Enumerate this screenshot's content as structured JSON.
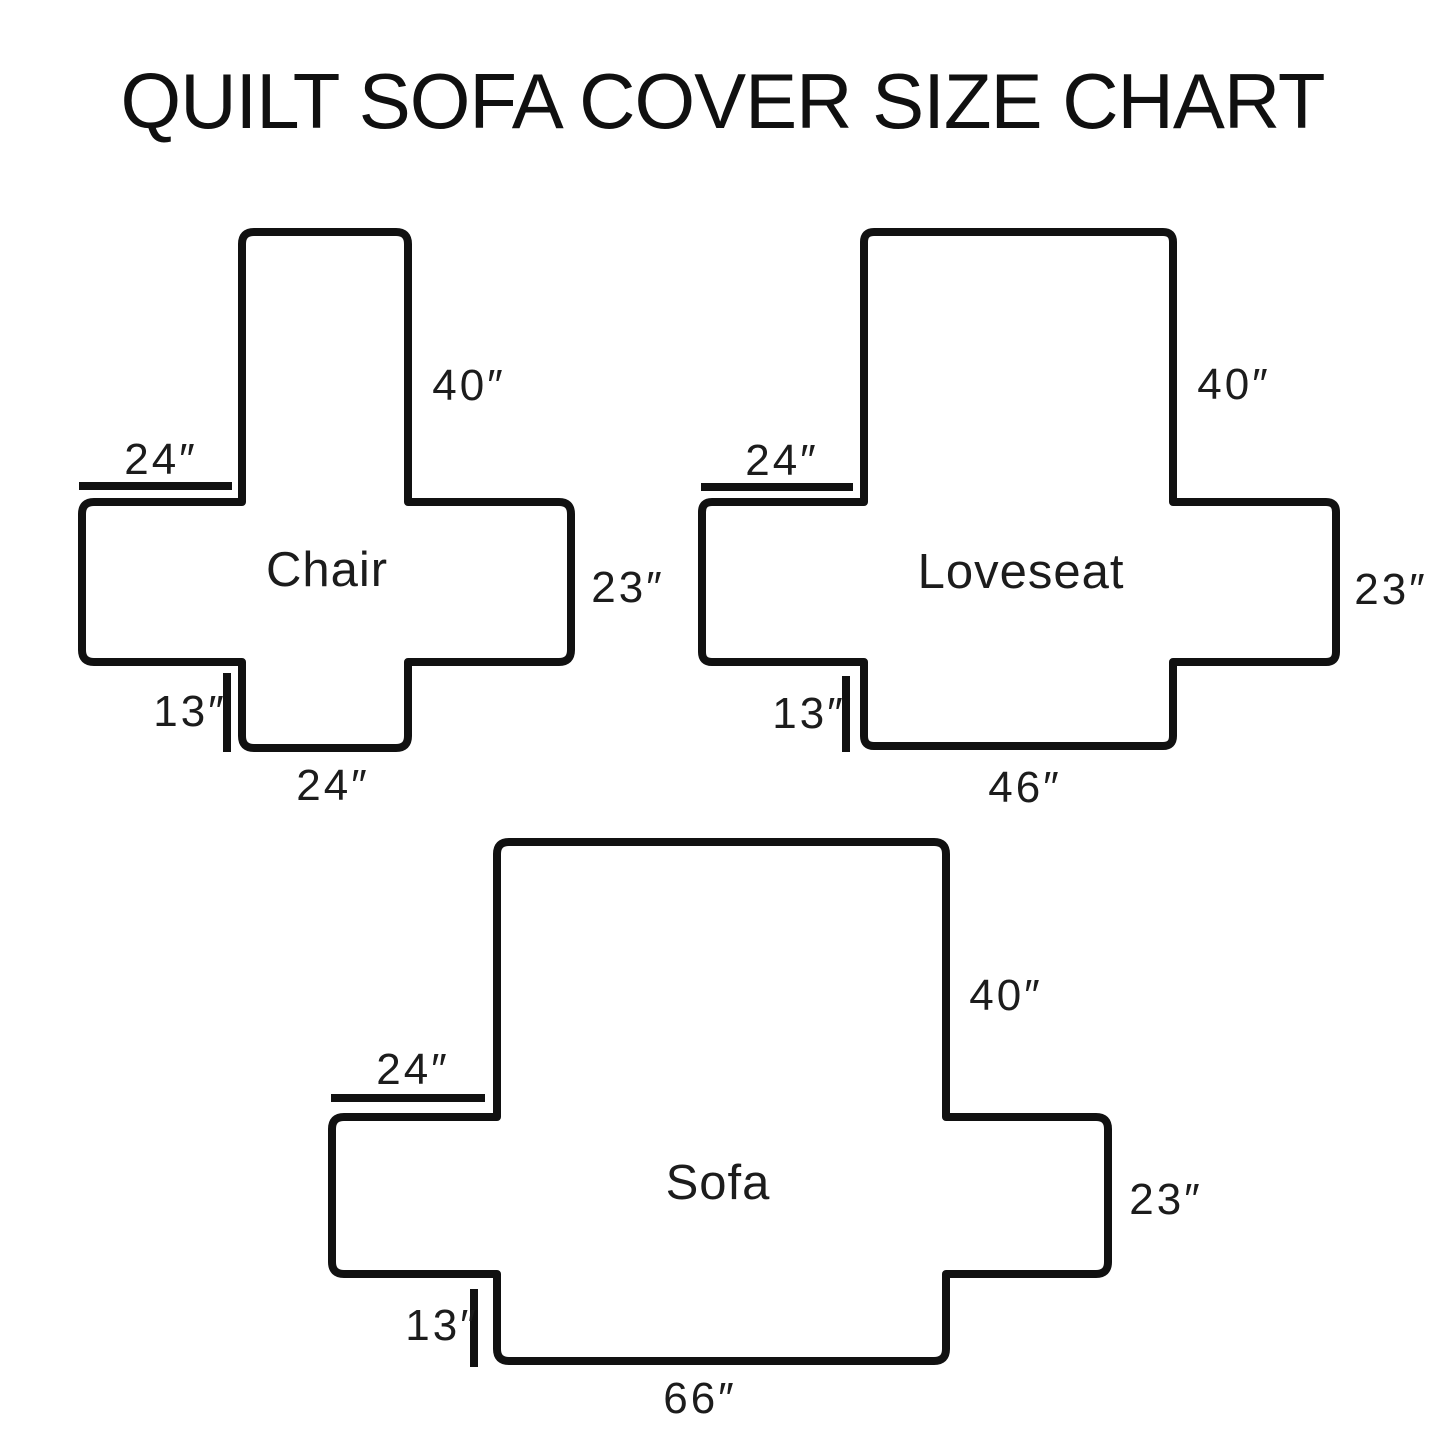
{
  "title": "QUILT SOFA COVER SIZE CHART",
  "diagrams": [
    {
      "name": "Chair",
      "dims": {
        "back_height": "40″",
        "arm_top_width": "24″",
        "side_depth": "23″",
        "front_drop": "13″",
        "seat_width": "24″"
      },
      "dims_numeric": {
        "back_height_in": 40,
        "arm_top_width_in": 24,
        "side_depth_in": 23,
        "front_drop_in": 13,
        "seat_width_in": 24
      }
    },
    {
      "name": "Loveseat",
      "dims": {
        "back_height": "40″",
        "arm_top_width": "24″",
        "side_depth": "23″",
        "front_drop": "13″",
        "seat_width": "46″"
      },
      "dims_numeric": {
        "back_height_in": 40,
        "arm_top_width_in": 24,
        "side_depth_in": 23,
        "front_drop_in": 13,
        "seat_width_in": 46
      }
    },
    {
      "name": "Sofa",
      "dims": {
        "back_height": "40″",
        "arm_top_width": "24″",
        "side_depth": "23″",
        "front_drop": "13″",
        "seat_width": "66″"
      },
      "dims_numeric": {
        "back_height_in": 40,
        "arm_top_width_in": 24,
        "side_depth_in": 23,
        "front_drop_in": 13,
        "seat_width_in": 66
      }
    }
  ],
  "style": {
    "outline_color": "#111111",
    "background_color": "#ffffff"
  }
}
